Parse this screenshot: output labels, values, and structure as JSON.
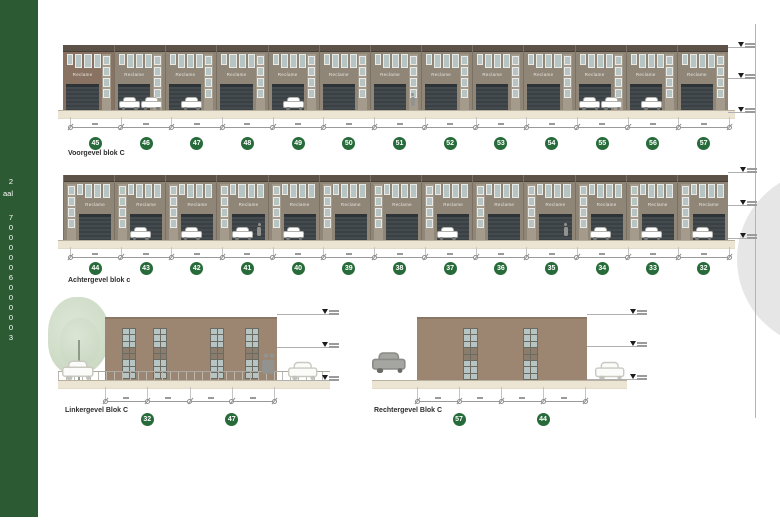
{
  "sign": "Reclame",
  "sidebar": {
    "fragments": [
      "2",
      "aal",
      "7",
      "0",
      "0",
      "0",
      "0",
      "0",
      "6",
      "0",
      "0",
      "0",
      "0",
      "0",
      "3"
    ]
  },
  "elevations": {
    "voorgevel": {
      "label": "Voorgevel blok C",
      "units": [
        {
          "no": "45",
          "front": []
        },
        {
          "no": "46",
          "front": [
            "car",
            "car"
          ]
        },
        {
          "no": "47",
          "front": [
            "car"
          ]
        },
        {
          "no": "48",
          "front": []
        },
        {
          "no": "49",
          "front": [
            "car"
          ]
        },
        {
          "no": "50",
          "front": []
        },
        {
          "no": "51",
          "front": [
            "person"
          ]
        },
        {
          "no": "52",
          "front": []
        },
        {
          "no": "53",
          "front": []
        },
        {
          "no": "54",
          "front": []
        },
        {
          "no": "55",
          "front": [
            "car",
            "car"
          ]
        },
        {
          "no": "56",
          "front": [
            "car"
          ]
        },
        {
          "no": "57",
          "front": []
        }
      ]
    },
    "achtergevel": {
      "label": "Achtergevel blok c",
      "units": [
        {
          "no": "44",
          "front": []
        },
        {
          "no": "43",
          "front": [
            "car"
          ]
        },
        {
          "no": "42",
          "front": [
            "car"
          ]
        },
        {
          "no": "41",
          "front": [
            "car",
            "person"
          ]
        },
        {
          "no": "40",
          "front": [
            "car"
          ]
        },
        {
          "no": "39",
          "front": []
        },
        {
          "no": "38",
          "front": []
        },
        {
          "no": "37",
          "front": [
            "car"
          ]
        },
        {
          "no": "36",
          "front": []
        },
        {
          "no": "35",
          "front": [
            "person"
          ]
        },
        {
          "no": "34",
          "front": [
            "car"
          ]
        },
        {
          "no": "33",
          "front": [
            "car"
          ]
        },
        {
          "no": "32",
          "front": [
            "car"
          ]
        }
      ]
    },
    "linkergevel": {
      "label": "Linkergevel Blok C",
      "badges": [
        "32",
        "47"
      ]
    },
    "rechtergevel": {
      "label": "Rechtergevel Blok C",
      "badges": [
        "57",
        "44"
      ]
    }
  },
  "colors": {
    "sidebarGreen": "#2c5b33",
    "badgeGreen": "#276b3a",
    "facade": "#8f8678",
    "facadeFirst": "#8a7263",
    "band": "#5d5248",
    "glass": "#b6c4c3",
    "strip": "#a49b8d",
    "ground": "#ece5d4",
    "sideFacade": "#9c8672",
    "spandrel": "#8c7c6b",
    "frame": "#6b6b62",
    "watermark": "#e6e6e6"
  }
}
